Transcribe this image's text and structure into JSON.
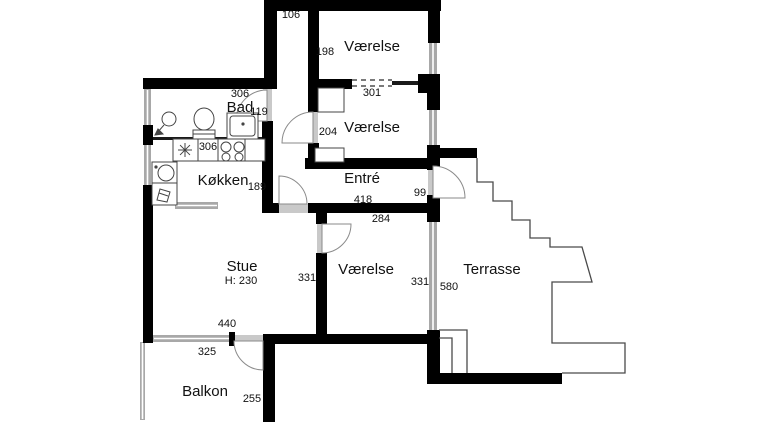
{
  "title": "Apartment floor plan",
  "canvas": {
    "width": 768,
    "height": 422
  },
  "colors": {
    "wall": "#000000",
    "thin_wall": "#1a1a1a",
    "window": "#a8a8a8",
    "window_core": "#ffffff",
    "threshold": "#c9c9c9",
    "door": "#8a8a8a",
    "outline": "#4a4a4a",
    "fixture": "#444444",
    "text": "#111111",
    "background": "#ffffff"
  },
  "rooms": [
    {
      "label": "Værelse",
      "x": 372,
      "y": 51,
      "size": 15
    },
    {
      "label": "Værelse",
      "x": 372,
      "y": 132,
      "size": 15
    },
    {
      "label": "Bad",
      "x": 240,
      "y": 112,
      "size": 15
    },
    {
      "label": "Køkken",
      "x": 223,
      "y": 185,
      "size": 15
    },
    {
      "label": "Entré",
      "x": 362,
      "y": 183,
      "size": 15
    },
    {
      "label": "Stue",
      "x": 242,
      "y": 271,
      "size": 15,
      "sub": "H: 230",
      "sub_x": 241,
      "sub_y": 284,
      "sub_size": 11
    },
    {
      "label": "Værelse",
      "x": 366,
      "y": 274,
      "size": 15
    },
    {
      "label": "Terrasse",
      "x": 492,
      "y": 274,
      "size": 15
    },
    {
      "label": "Balkon",
      "x": 205,
      "y": 396,
      "size": 15
    }
  ],
  "dimensions": [
    {
      "text": "106",
      "x": 291,
      "y": 18
    },
    {
      "text": "198",
      "x": 325,
      "y": 55
    },
    {
      "text": "301",
      "x": 372,
      "y": 96
    },
    {
      "text": "306",
      "x": 240,
      "y": 97
    },
    {
      "text": "119",
      "x": 259,
      "y": 115
    },
    {
      "text": "204",
      "x": 328,
      "y": 135
    },
    {
      "text": "306",
      "x": 208,
      "y": 150
    },
    {
      "text": "189",
      "x": 257,
      "y": 190
    },
    {
      "text": "418",
      "x": 363,
      "y": 203
    },
    {
      "text": "99",
      "x": 420,
      "y": 196
    },
    {
      "text": "284",
      "x": 381,
      "y": 222
    },
    {
      "text": "331",
      "x": 307,
      "y": 281
    },
    {
      "text": "331",
      "x": 420,
      "y": 285
    },
    {
      "text": "580",
      "x": 449,
      "y": 290
    },
    {
      "text": "440",
      "x": 227,
      "y": 327
    },
    {
      "text": "325",
      "x": 207,
      "y": 355
    },
    {
      "text": "255",
      "x": 252,
      "y": 402
    }
  ],
  "walls": [
    [
      264,
      0,
      177,
      11
    ],
    [
      264,
      0,
      13,
      89
    ],
    [
      143,
      78,
      134,
      11
    ],
    [
      308,
      8,
      11,
      72
    ],
    [
      308,
      79,
      44,
      10
    ],
    [
      418,
      74,
      22,
      19
    ],
    [
      428,
      0,
      12,
      43
    ],
    [
      427,
      75,
      13,
      35
    ],
    [
      427,
      145,
      13,
      25
    ],
    [
      440,
      148,
      37,
      10
    ],
    [
      305,
      158,
      125,
      11
    ],
    [
      308,
      89,
      11,
      23
    ],
    [
      308,
      143,
      11,
      26
    ],
    [
      262,
      121,
      11,
      82
    ],
    [
      143,
      125,
      10,
      20
    ],
    [
      262,
      203,
      17,
      10
    ],
    [
      308,
      203,
      122,
      10
    ],
    [
      427,
      195,
      13,
      27
    ],
    [
      316,
      213,
      11,
      11
    ],
    [
      316,
      253,
      11,
      81
    ],
    [
      263,
      334,
      170,
      10
    ],
    [
      263,
      334,
      12,
      88
    ],
    [
      229,
      332,
      6,
      14
    ],
    [
      427,
      330,
      13,
      54
    ],
    [
      427,
      373,
      135,
      11
    ],
    [
      143,
      185,
      10,
      158
    ]
  ],
  "thin_walls": [
    [
      153,
      137,
      109,
      3
    ],
    [
      392,
      81,
      26,
      4
    ]
  ],
  "windows": [
    {
      "r": [
        144,
        89,
        7,
        37
      ],
      "o": "v"
    },
    {
      "r": [
        144,
        144,
        7,
        42
      ],
      "o": "v"
    },
    {
      "r": [
        153,
        335,
        80,
        7
      ],
      "o": "h"
    },
    {
      "r": [
        429,
        42,
        8,
        34
      ],
      "o": "v"
    },
    {
      "r": [
        429,
        109,
        8,
        37
      ],
      "o": "v"
    },
    {
      "r": [
        429,
        221,
        8,
        110
      ],
      "o": "v"
    },
    {
      "r": [
        175,
        202,
        43,
        7
      ],
      "o": "h"
    },
    {
      "r": [
        140,
        342,
        5,
        78
      ],
      "o": "v"
    }
  ],
  "thresholds": [
    [
      263,
      89,
      9,
      32
    ],
    [
      309,
      112,
      9,
      31
    ],
    [
      279,
      204,
      29,
      9
    ],
    [
      317,
      224,
      9,
      29
    ],
    [
      428,
      170,
      12,
      28
    ],
    [
      235,
      335,
      28,
      8
    ]
  ],
  "doors": [
    {
      "name": "bad-door",
      "path": "M267,121 L267,90 A31,31 0 0 0 236,121 Z"
    },
    {
      "name": "vaerelse2-door",
      "path": "M313,143 L313,112 A31,31 0 0 0 282,143 Z"
    },
    {
      "name": "stue-door",
      "path": "M279,204 L279,176 A28,28 0 0 1 307,204 Z"
    },
    {
      "name": "vaerelse3-door",
      "path": "M322,224 L322,253 A29,29 0 0 0 351,224 Z"
    },
    {
      "name": "terrasse-door",
      "path": "M433,198 L433,166 A32,32 0 0 1 465,198 Z"
    },
    {
      "name": "balkon-door",
      "path": "M263,341 L234,341 A29,29 0 0 0 263,370 Z"
    }
  ],
  "outlines": [
    {
      "name": "terrasse-outline",
      "path": "M477,158 L477,182 L493,182 L493,201 L512,201 L512,220 L530,220 L530,238 L550,238 L550,247 L582,247 L592,282 L552,282 L552,343 L625,343 L625,373 L562,373"
    },
    {
      "name": "terrasse-steps",
      "path": "M439,330 L467,330 L467,373 M439,338 L452,338 L452,373"
    }
  ],
  "dashed_lines": [
    {
      "x1": 352,
      "y1": 80,
      "x2": 392,
      "y2": 80
    },
    {
      "x1": 352,
      "y1": 86,
      "x2": 392,
      "y2": 86
    }
  ],
  "fixtures": [
    {
      "t": "circle",
      "name": "shower-head-icon",
      "cx": 169,
      "cy": 119,
      "r": 7
    },
    {
      "t": "line",
      "name": "shower-arm",
      "x1": 164,
      "y1": 125,
      "x2": 157,
      "y2": 133
    },
    {
      "t": "path",
      "name": "shower-spray",
      "d": "M155,135 l8,-1 l-5,-5 z",
      "fill": "#444444"
    },
    {
      "t": "ellipse",
      "name": "toilet-bowl-icon",
      "cx": 204,
      "cy": 119,
      "rx": 10,
      "ry": 11
    },
    {
      "t": "rect",
      "name": "toilet-tank",
      "x": 193,
      "y": 130,
      "w": 22,
      "h": 10,
      "fill": "#ffffff"
    },
    {
      "t": "line",
      "name": "toilet-tank-line",
      "x1": 193,
      "y1": 134,
      "x2": 215,
      "y2": 134
    },
    {
      "t": "rect",
      "name": "bath-sink-unit",
      "x": 227,
      "y": 113,
      "w": 31,
      "h": 26,
      "fill": "#ffffff"
    },
    {
      "t": "rect",
      "name": "bath-sink-basin",
      "x": 230,
      "y": 116,
      "w": 25,
      "h": 20,
      "rx": 3
    },
    {
      "t": "dot",
      "name": "bath-faucet-icon",
      "cx": 243,
      "cy": 124,
      "r": 1.6
    },
    {
      "t": "rect",
      "name": "kitchen-counter",
      "x": 173,
      "y": 139,
      "w": 92,
      "h": 22,
      "fill": "#ffffff"
    },
    {
      "t": "line",
      "name": "counter-divider",
      "x1": 198,
      "y1": 139,
      "x2": 198,
      "y2": 161
    },
    {
      "t": "line",
      "name": "counter-divider",
      "x1": 218,
      "y1": 139,
      "x2": 218,
      "y2": 161
    },
    {
      "t": "line",
      "name": "counter-divider",
      "x1": 245,
      "y1": 139,
      "x2": 245,
      "y2": 161
    },
    {
      "t": "star",
      "name": "hob-symbol-icon",
      "cx": 185,
      "cy": 150,
      "r": 7
    },
    {
      "t": "circle",
      "name": "stove-burner-icon",
      "cx": 226,
      "cy": 147,
      "r": 5
    },
    {
      "t": "circle",
      "name": "stove-burner-icon",
      "cx": 239,
      "cy": 147,
      "r": 5
    },
    {
      "t": "circle",
      "name": "stove-burner-icon",
      "cx": 226,
      "cy": 157,
      "r": 4
    },
    {
      "t": "circle",
      "name": "stove-burner-icon",
      "cx": 239,
      "cy": 157,
      "r": 4
    },
    {
      "t": "rect",
      "name": "kitchen-sink-unit",
      "x": 152,
      "y": 162,
      "w": 25,
      "h": 21,
      "fill": "#ffffff"
    },
    {
      "t": "circle",
      "name": "kitchen-sink-icon",
      "cx": 166,
      "cy": 173,
      "r": 8
    },
    {
      "t": "dot",
      "name": "kitchen-faucet-icon",
      "cx": 156,
      "cy": 167,
      "r": 1.6
    },
    {
      "t": "rect",
      "name": "dishwasher-unit",
      "x": 152,
      "y": 183,
      "w": 25,
      "h": 22,
      "fill": "#ffffff"
    },
    {
      "t": "path",
      "name": "dishwasher-symbol",
      "d": "M157,200 l3,-11 l10,3 l-3,10 z"
    },
    {
      "t": "line",
      "name": "dishwasher-line",
      "x1": 159,
      "y1": 193,
      "x2": 168,
      "y2": 196
    },
    {
      "t": "rect",
      "name": "closet",
      "x": 318,
      "y": 88,
      "w": 26,
      "h": 24,
      "fill": "#ffffff"
    },
    {
      "t": "rect",
      "name": "closet",
      "x": 315,
      "y": 148,
      "w": 29,
      "h": 14,
      "fill": "#ffffff"
    }
  ]
}
